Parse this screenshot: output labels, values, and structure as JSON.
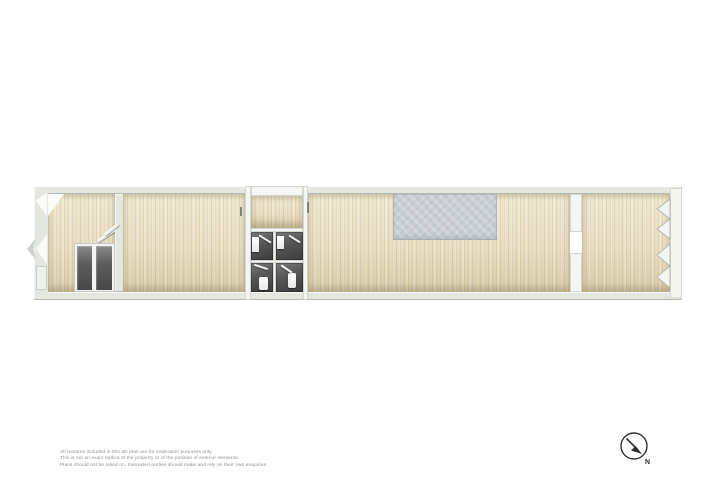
{
  "disclaimer": {
    "line1": "All features included in this 3D plan are for inspiration purposes only.",
    "line2": "This is not an exact replica of the property or of the position of exterior elements.",
    "line3": "Plans should not be relied on. Interested parties should make and rely on their own enquiries."
  },
  "compass": {
    "label": "N",
    "icon": "north-arrow-icon",
    "arrow_direction": "down-right"
  },
  "colors": {
    "wall": "#e3e7df",
    "wall_white": "#f5f6f3",
    "floor_wood": "#e9dec3",
    "floor_wood_dark": "#d9cca9",
    "kitchen_floor": "#c8ced3",
    "bathroom_floor": "#3c3c3c",
    "wardrobe_interior": "#5d5d5d",
    "compass_ink": "#2e2e2e",
    "disclaimer_text": "#8f8f8f"
  }
}
